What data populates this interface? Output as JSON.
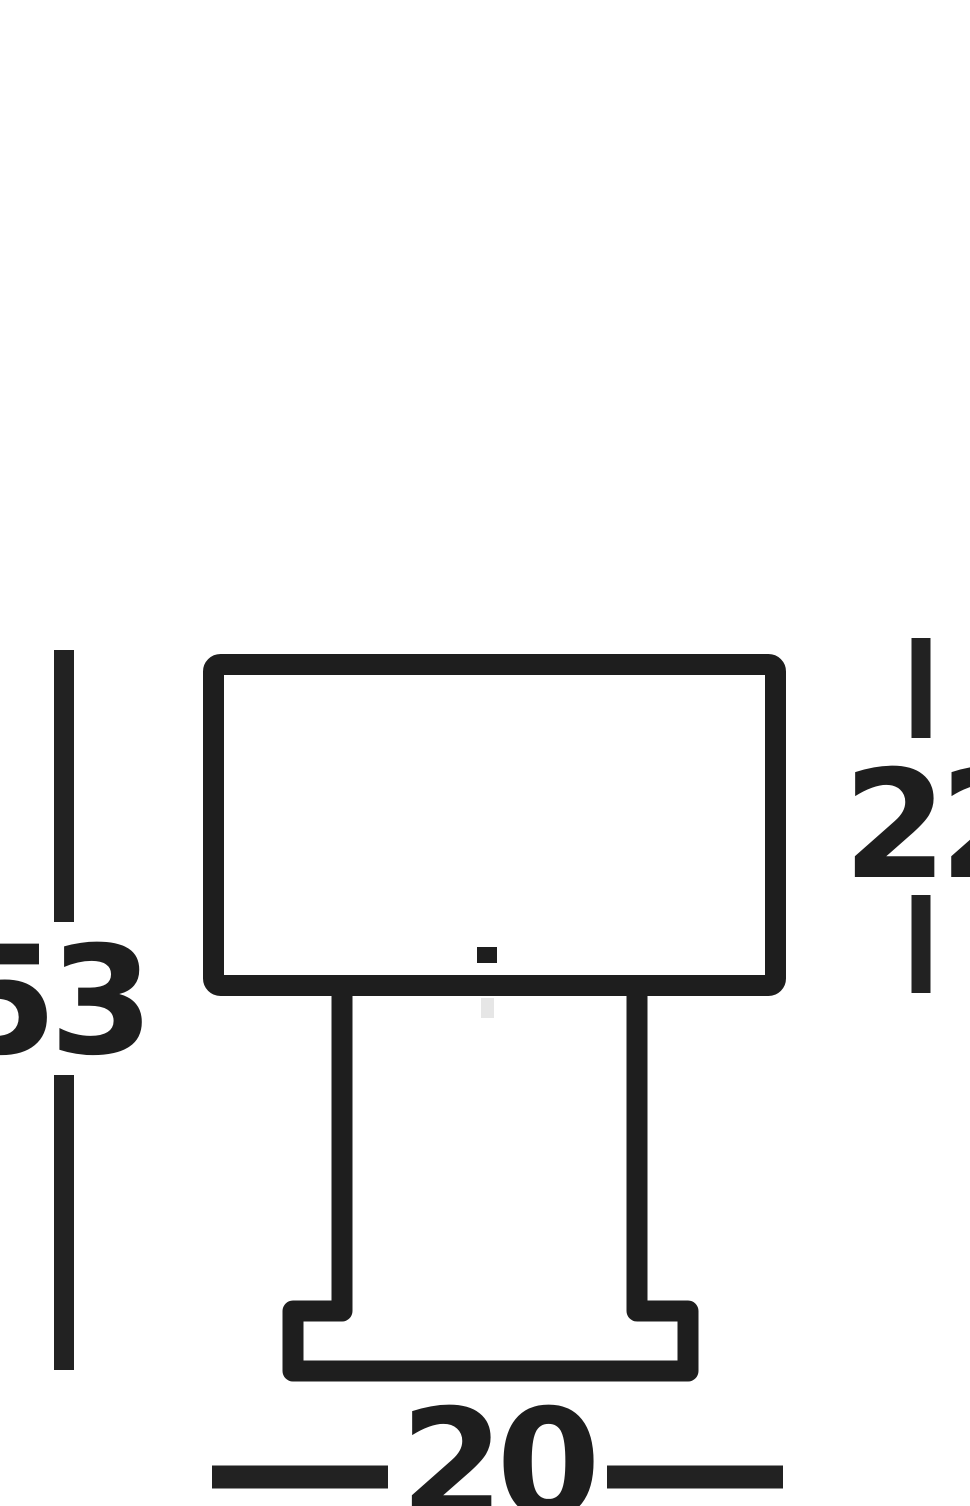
{
  "diagram": {
    "kind": "product-dimension-drawing",
    "subject": "table-lamp-front-elevation",
    "background_color": "#ffffff",
    "line_color": "#1e1e1e",
    "faint_seam_color": "#c8c8c8",
    "dimensions": {
      "overall_height": {
        "value": "53",
        "orientation": "vertical",
        "side": "left",
        "measures": "total lamp height"
      },
      "shade_height": {
        "value": "22",
        "orientation": "vertical",
        "side": "right",
        "measures": "shade height"
      },
      "base_width": {
        "value": "20",
        "orientation": "horizontal",
        "side": "bottom",
        "measures": "base width"
      }
    }
  }
}
